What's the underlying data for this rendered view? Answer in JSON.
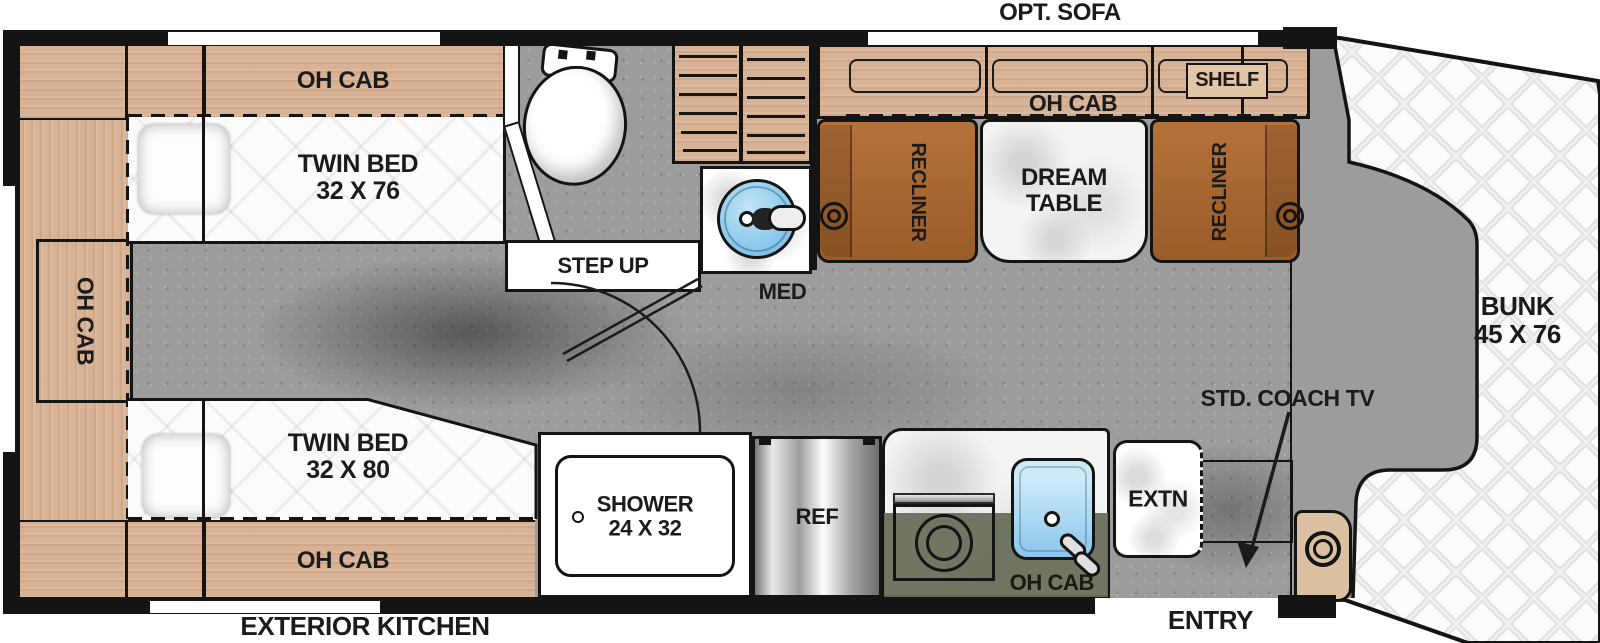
{
  "bedroom": {
    "oh_cab_top": "OH CAB",
    "oh_cab_left": "OH CAB",
    "oh_cab_bottom": "OH CAB",
    "bed_top": {
      "line1": "TWIN BED",
      "line2": "32 X 76"
    },
    "bed_bottom": {
      "line1": "TWIN BED",
      "line2": "32 X 80"
    }
  },
  "bathroom": {
    "step_up": "STEP UP",
    "med": "MED",
    "shower": {
      "line1": "SHOWER",
      "line2": "24 X 32"
    }
  },
  "living": {
    "opt_sofa": "OPT. SOFA",
    "oh_cab": "OH CAB",
    "shelf": "SHELF",
    "recliner_left": "RECLINER",
    "recliner_right": "RECLINER",
    "table": {
      "line1": "DREAM",
      "line2": "TABLE"
    }
  },
  "kitchen": {
    "ref": "REF",
    "oh_cab": "OH CAB",
    "extn": "EXTN",
    "exterior": "EXTERIOR KITCHEN"
  },
  "cab": {
    "bunk": {
      "line1": "BUNK",
      "line2": "45 X 76"
    },
    "tv": "STD. COACH TV",
    "entry": "ENTRY"
  },
  "colors": {
    "wood": "#d8b294",
    "recliner_brown": "#ad6a31",
    "olive_counter": "#6f7560",
    "sink_blue": "#8ecdef",
    "floor_gray": "#9c9c9c",
    "wall_black": "#141414",
    "mattress_white": "#fbfbfb"
  }
}
